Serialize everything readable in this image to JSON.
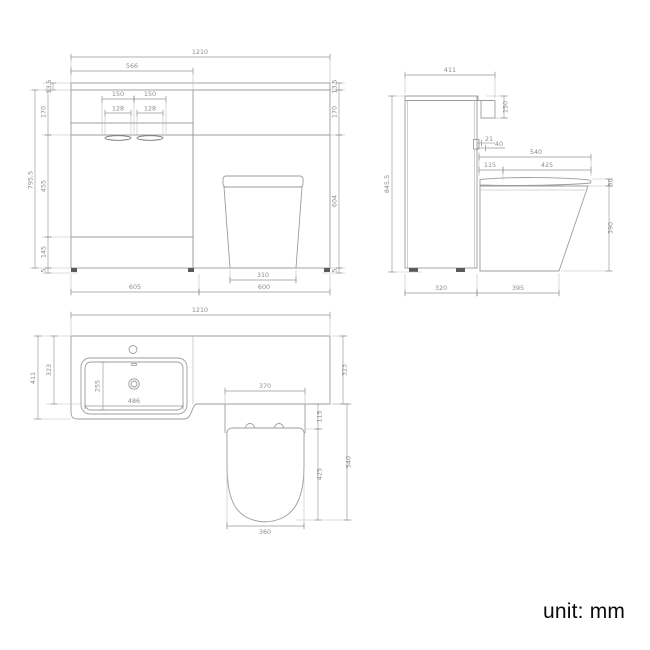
{
  "unit_label": "unit: mm",
  "front": {
    "w_total": "1210",
    "w_vanity": "566",
    "w_handle": "150",
    "w_cutout": "128",
    "h_worktop": "13,5",
    "h_rail": "170",
    "h_total": "795,5",
    "h_door": "455",
    "h_plinth": "145",
    "h_foot": "5",
    "h_panel": "604",
    "w_base_vanity": "605",
    "w_base_wc": "600",
    "w_pan": "310"
  },
  "side": {
    "d_total": "411",
    "h_total": "845,5",
    "h_splash": "150",
    "d_clip": "21",
    "d_clip2": "40",
    "d_pan": "540",
    "d_seat_inset": "115",
    "d_seat": "425",
    "h_seat": "30",
    "h_pan": "390",
    "d_cabinet": "320",
    "d_projection": "395"
  },
  "plan": {
    "w_total": "1210",
    "d_vanity": "411",
    "d_worktop": "323",
    "w_basin": "486",
    "d_basin": "255",
    "w_pan": "370",
    "d_hinge": "115",
    "d_seat": "425",
    "d_pan": "540",
    "w_seat": "360"
  }
}
